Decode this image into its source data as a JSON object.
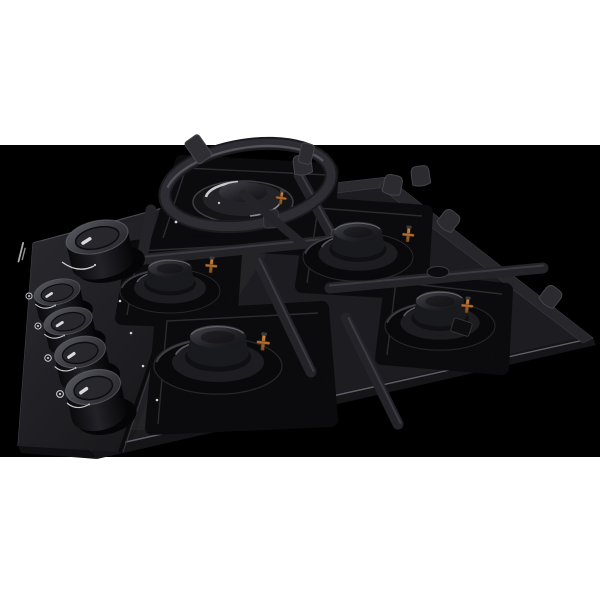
{
  "scene": {
    "kind": "product-photo",
    "subject": "Black built-in gas hob with five burners, cast-iron pan supports, a wok ring over the large rear-left burner, and a left-side strip with five control knobs, photographed at a three-quarter angle on a black background",
    "canvas_color": "#ffffff",
    "photo_background_color": "#000000"
  },
  "hob": {
    "surface_finish": "black tempered glass",
    "glass_color": "#1a1a1e",
    "well_color": "#0b0b0d",
    "grate_color": "#232328",
    "edge_highlight_color": "#5e5e66",
    "burner_count": 5,
    "burners": [
      {
        "id": "wok-burner-rear-left",
        "size": "large",
        "wok_ring": true,
        "metal_highlight_color": "#c9c9ce"
      },
      {
        "id": "burner-left",
        "size": "medium"
      },
      {
        "id": "burner-rear-right",
        "size": "medium"
      },
      {
        "id": "burner-front-center",
        "size": "large"
      },
      {
        "id": "burner-front-right",
        "size": "medium"
      }
    ],
    "igniter_color": "#b06c30",
    "pan_support_prongs": true
  },
  "controls": {
    "knob_count": 5,
    "knob_color": "#2e2e33",
    "knob_top_color": "#55555d",
    "indicator_color": "#dadade",
    "marking_color": "#d6d6da",
    "brand_marking": "illegible small light text beside top knob",
    "knobs": [
      {
        "id": "knob-wok",
        "position": "top of strip"
      },
      {
        "id": "knob-1",
        "position": "group of four"
      },
      {
        "id": "knob-2",
        "position": "group of four"
      },
      {
        "id": "knob-3",
        "position": "group of four"
      },
      {
        "id": "knob-4",
        "position": "group of four"
      }
    ]
  }
}
